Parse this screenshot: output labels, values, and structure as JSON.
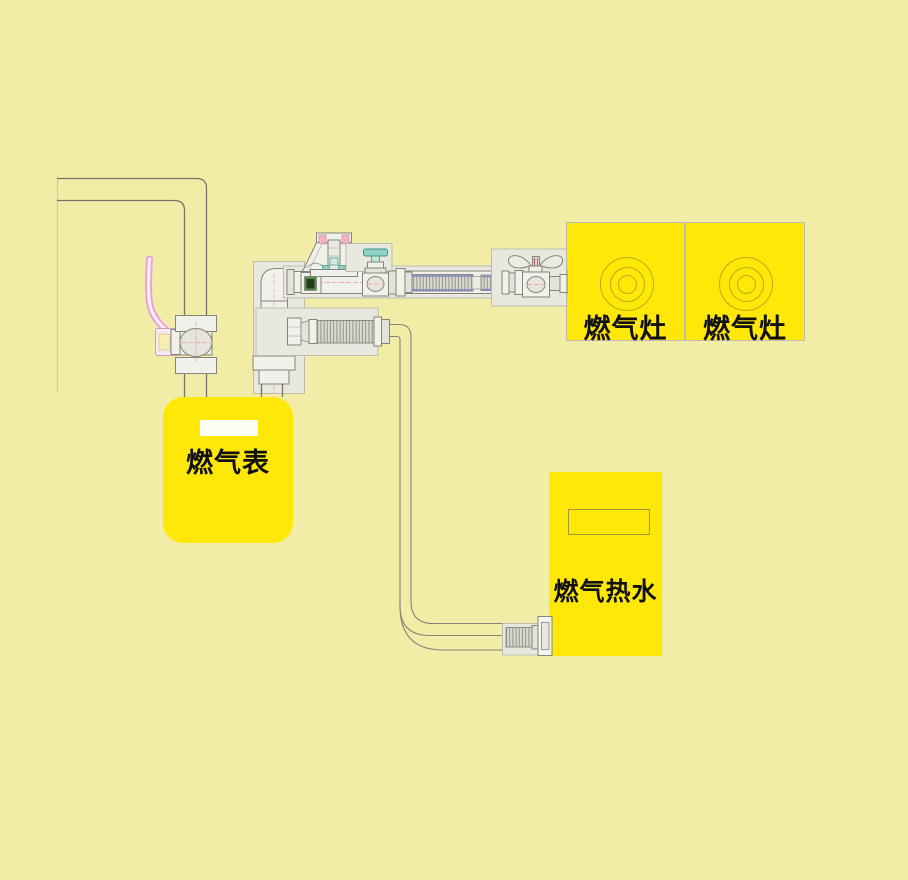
{
  "labels": {
    "gas_meter": "燃气表",
    "stove_left": "燃气灶",
    "stove_right": "燃气灶",
    "water_heater": "燃气热水"
  },
  "colors": {
    "background": "#f1eda7",
    "appliance_yellow": "#ffe808",
    "outline_gray": "#84847a",
    "panel_gray": "#e9e8df",
    "hose_blue": "#8088c8",
    "handle_pink": "#ef9fd7",
    "knob_teal": "#8ed2c4",
    "label_text": "#111111"
  }
}
